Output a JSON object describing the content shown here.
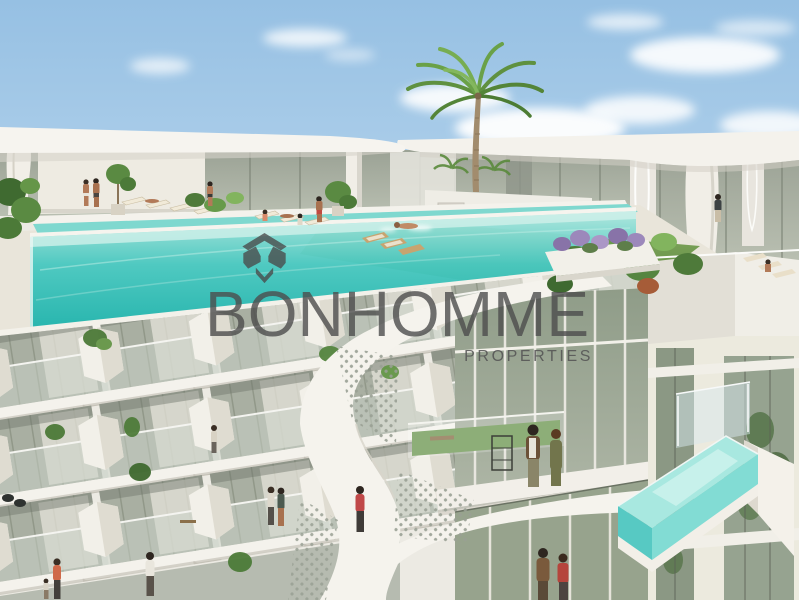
{
  "watermark": {
    "brand": "BONHOMME",
    "subtitle": "PROPERTIES",
    "logo_icon": "bonhomme-geometric-diamond",
    "text_color": "#4c4c4c"
  },
  "scene": {
    "type": "architectural-3d-render",
    "subject": "luxury-residential-building",
    "colors": {
      "sky": "#9fc6e6",
      "cloud": "#ffffff",
      "building_white": "#f3f1ec",
      "facade_glass": "#a9afa2",
      "pool_water": "#3ec6bd",
      "cantilever_pool_water": "#7fd9d2",
      "lawn_green": "#6d9852",
      "lavender": "#9c88bb",
      "palm_green": "#6aa148"
    },
    "elements": [
      "sky-clouds",
      "roof-canopy",
      "rooftop-infinity-pool",
      "swimmer",
      "sun-loungers",
      "rooftop-lawn",
      "palm-tree",
      "lavender-planter",
      "residents",
      "balcony-facade",
      "perforated-ribbon-structure",
      "terrace-walkway",
      "cantilever-glass-pool",
      "distant-hills"
    ]
  }
}
